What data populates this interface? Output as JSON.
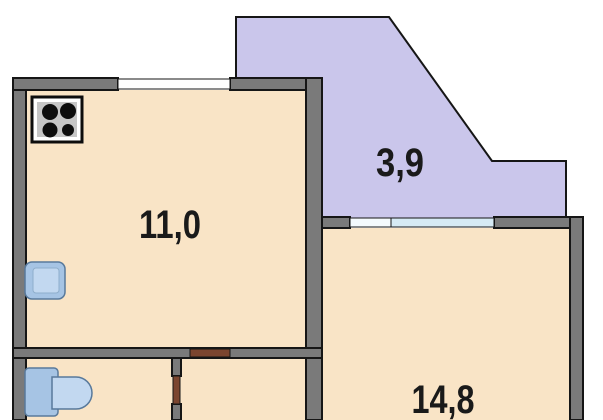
{
  "plan": {
    "title": "apartment-floor-plan",
    "rooms": [
      {
        "name": "kitchen",
        "area_label": "11,0"
      },
      {
        "name": "balcony",
        "area_label": "3,9"
      },
      {
        "name": "living-room",
        "area_label": "14,8"
      }
    ],
    "fixtures": [
      {
        "icon": "stove-icon",
        "location": "kitchen top-left"
      },
      {
        "icon": "sink-icon",
        "location": "kitchen left wall"
      },
      {
        "icon": "toilet-icon",
        "location": "bathroom bottom-left"
      }
    ],
    "colors": {
      "background": "#ffffff",
      "room_fill": "#F9E4C6",
      "balcony_fill": "#CAC6EB",
      "wall_gray": "#7A7A7A",
      "outline_black": "#161616",
      "window_blue": "#D6EAF4",
      "opening_white": "#F4FAFD",
      "window_white": "#FDFDFD",
      "door_brown": "#7B452F",
      "fixture_blue": "#A6C4E4",
      "fixture_blue_light": "#C2D8F0",
      "fixture_stroke": "#58799B",
      "stove_plate_gray": "#C6C6C6",
      "burner_black": "#0D0D0D",
      "label_color": "#1A1A1A"
    }
  }
}
